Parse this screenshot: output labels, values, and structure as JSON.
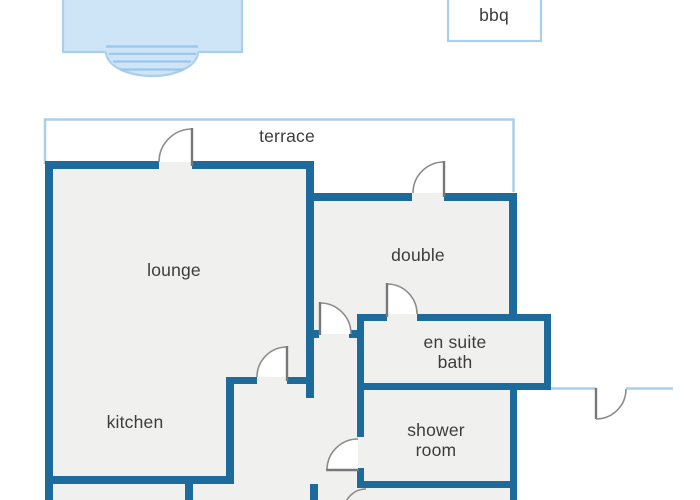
{
  "floorplan": {
    "outdoor": {
      "terrace_label": "terrace",
      "bbq_label": "bbq"
    },
    "rooms": {
      "lounge": "lounge",
      "kitchen": "kitchen",
      "double": "double",
      "ensuite_line1": "en suite",
      "ensuite_line2": "bath",
      "shower_line1": "shower",
      "shower_line2": "room"
    },
    "colors": {
      "wall": "#1c6b9c",
      "outdoor_outline": "#a9cfec",
      "pool_fill": "#cde5f7",
      "pool_steps": "#9bc6e9",
      "floor_fill": "#f0f1ef",
      "door_stroke": "#8c8c8c",
      "label_text": "#3c3c3c",
      "background": "#ffffff"
    }
  }
}
